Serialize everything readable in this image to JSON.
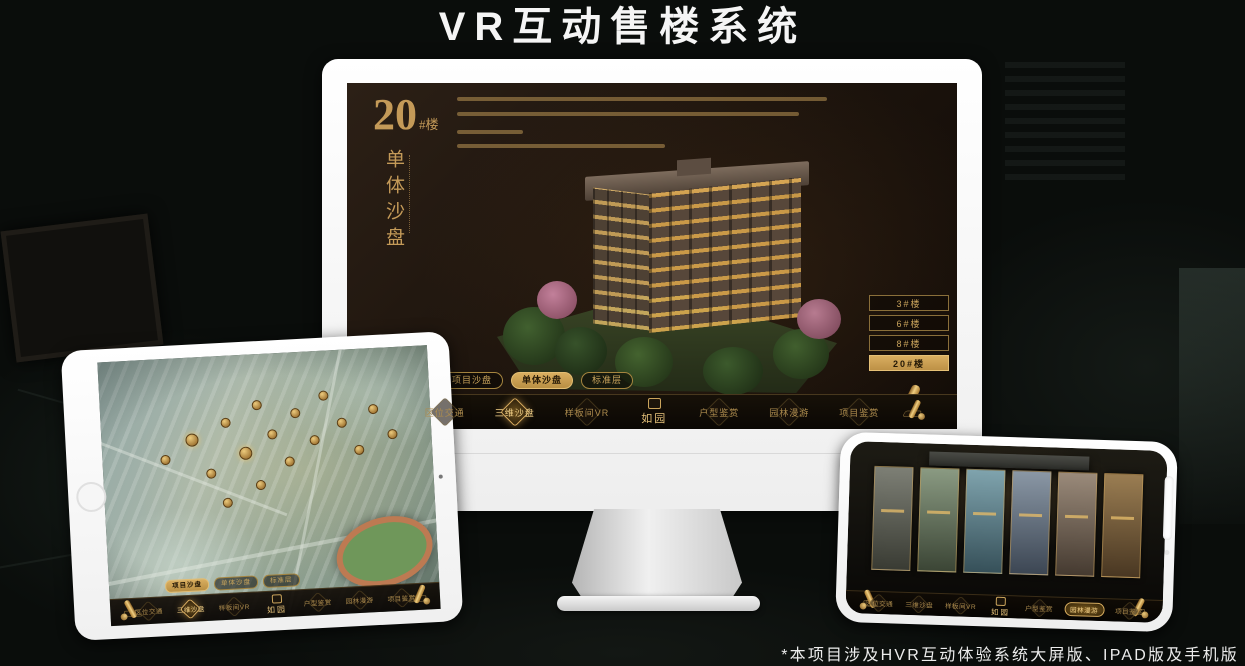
{
  "page": {
    "title": "VR互动售楼系统",
    "footnote": "*本项目涉及HVR互动体验系统大屏版、IPAD版及手机版"
  },
  "colors": {
    "accent_gold": "#c79a4e",
    "gold_text": "#caa45c",
    "screen_bg": "#1d140d",
    "device_white": "#f5f5f5"
  },
  "monitor_app": {
    "headline_number": "20",
    "headline_suffix": "#楼",
    "headline_title": "单体沙盘",
    "floor_buttons": [
      {
        "label": "3#楼",
        "active": false
      },
      {
        "label": "6#楼",
        "active": false
      },
      {
        "label": "8#楼",
        "active": false
      },
      {
        "label": "20#楼",
        "active": true
      }
    ],
    "sub_tabs": [
      {
        "label": "项目沙盘",
        "active": false
      },
      {
        "label": "单体沙盘",
        "active": true
      },
      {
        "label": "标准层",
        "active": false
      }
    ],
    "nav_left": [
      {
        "label": "区位交通",
        "active": false
      },
      {
        "label": "三维沙盘",
        "active": true
      },
      {
        "label": "样板间VR",
        "active": false
      }
    ],
    "logo_text": "如园",
    "nav_right": [
      {
        "label": "户型鉴赏",
        "active": false
      },
      {
        "label": "园林漫游",
        "active": false
      },
      {
        "label": "项目鉴赏",
        "active": false
      }
    ]
  },
  "tablet_app": {
    "sub_tabs": [
      {
        "label": "项目沙盘",
        "active": true
      },
      {
        "label": "单体沙盘",
        "active": false
      },
      {
        "label": "标准层",
        "active": false
      }
    ],
    "nav_left": [
      {
        "label": "区位交通",
        "active": false
      },
      {
        "label": "三维沙盘",
        "active": true
      },
      {
        "label": "样板间VR",
        "active": false
      }
    ],
    "logo_text": "如园",
    "nav_right": [
      {
        "label": "户型鉴赏",
        "active": false
      },
      {
        "label": "园林漫游",
        "active": false
      },
      {
        "label": "项目鉴赏",
        "active": false
      }
    ]
  },
  "phone_app": {
    "nav_left": [
      {
        "label": "区位交通",
        "active": false
      },
      {
        "label": "三维沙盘",
        "active": false
      },
      {
        "label": "样板间VR",
        "active": false
      }
    ],
    "logo_text": "如园",
    "nav_right": [
      {
        "label": "户型鉴赏",
        "active": false
      },
      {
        "label": "园林漫游",
        "active": true
      },
      {
        "label": "项目鉴赏",
        "active": false
      }
    ]
  }
}
